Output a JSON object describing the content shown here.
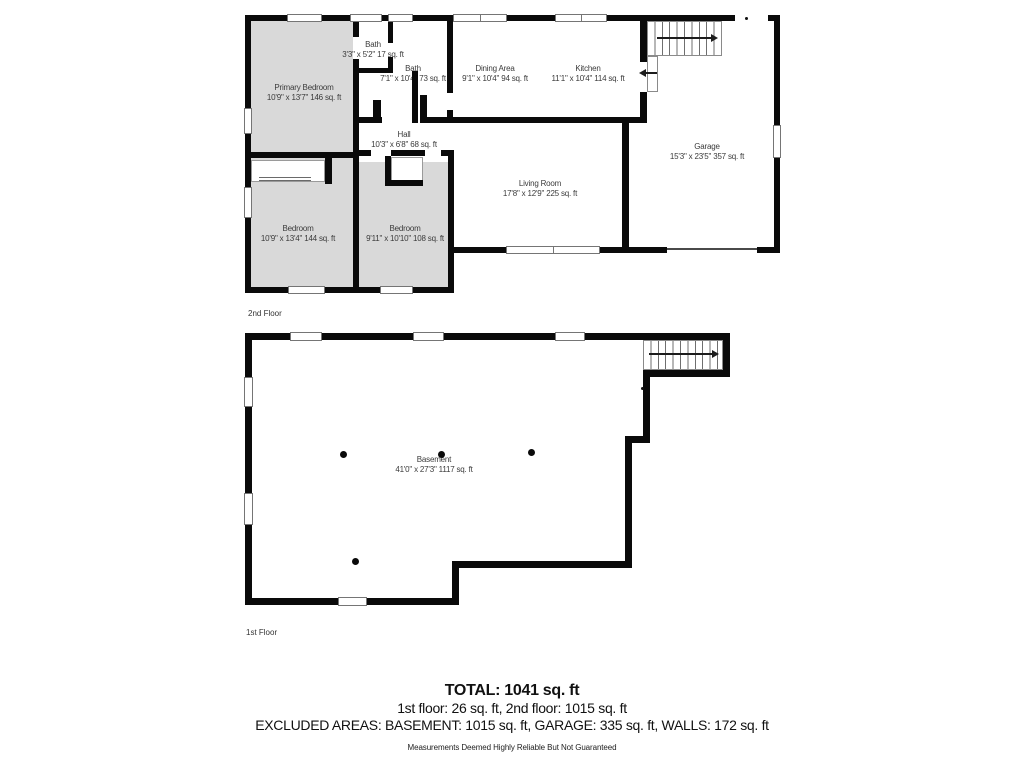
{
  "colors": {
    "wall": "#0a0a0a",
    "room_fill": "#d9d9d9",
    "label_text": "#3b3b3b"
  },
  "floors": [
    {
      "label": "2nd Floor",
      "rooms": [
        {
          "name": "Primary Bedroom",
          "dims": "10'9\" x 13'7\" 146 sq. ft"
        },
        {
          "name": "Bath",
          "dims": "3'3\" x 5'2\" 17 sq. ft"
        },
        {
          "name": "Bath",
          "dims": "7'1\" x 10'4\" 73 sq. ft"
        },
        {
          "name": "Dining Area",
          "dims": "9'1\" x 10'4\" 94 sq. ft"
        },
        {
          "name": "Kitchen",
          "dims": "11'1\" x 10'4\" 114 sq. ft"
        },
        {
          "name": "Hall",
          "dims": "10'3\" x 6'8\" 68 sq. ft"
        },
        {
          "name": "Living Room",
          "dims": "17'8\" x 12'9\" 225 sq. ft"
        },
        {
          "name": "Garage",
          "dims": "15'3\" x 23'5\" 357 sq. ft"
        },
        {
          "name": "Bedroom",
          "dims": "10'9\" x 13'4\" 144 sq. ft"
        },
        {
          "name": "Bedroom",
          "dims": "9'11\" x 10'10\" 108 sq. ft"
        }
      ]
    },
    {
      "label": "1st Floor",
      "rooms": [
        {
          "name": "Basement",
          "dims": "41'0\" x 27'3\" 1117 sq. ft"
        }
      ]
    }
  ],
  "summary": {
    "total": "TOTAL: 1041 sq. ft",
    "floors_line": "1st floor: 26 sq. ft, 2nd floor: 1015 sq. ft",
    "excluded_line": "EXCLUDED AREAS: BASEMENT: 1015 sq. ft, GARAGE: 335 sq. ft, WALLS: 172 sq. ft",
    "disclaimer": "Measurements Deemed Highly Reliable But Not Guaranteed"
  }
}
